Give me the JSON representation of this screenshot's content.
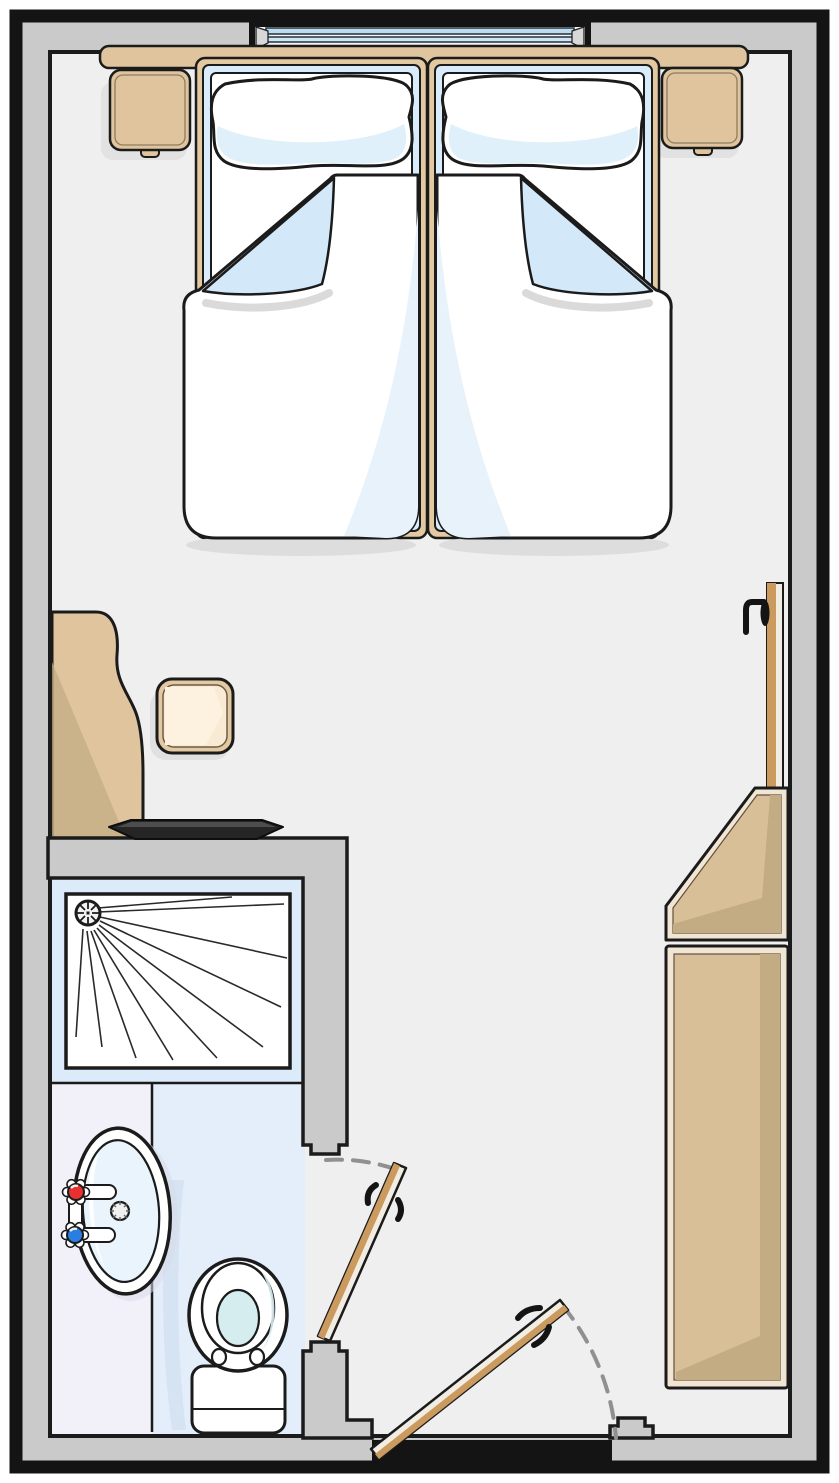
{
  "document": {
    "kind": "floor-plan",
    "view": "top-down",
    "scene": "twin hotel room with en-suite bathroom",
    "visible_text": "none"
  },
  "plan": {
    "rooms": [
      {
        "name": "bedroom",
        "items": [
          "window",
          "headboard",
          "nightstand-left",
          "nightstand-right",
          "twin-bed-left",
          "twin-bed-right",
          "pillow",
          "duvet-with-folded-corner",
          "desk",
          "stool",
          "tv",
          "closet-door-leaf",
          "wardrobe-corner-unit",
          "wardrobe",
          "entrance-door"
        ]
      },
      {
        "name": "bathroom",
        "items": [
          "shower-tray",
          "shower-drain",
          "shower-spray-lines",
          "washbasin",
          "hot-tap",
          "cold-tap",
          "sink-drain",
          "toilet",
          "bathroom-door"
        ]
      }
    ],
    "doors": [
      {
        "name": "bathroom-door",
        "state": "partly-open",
        "swing": "dashed-arc"
      },
      {
        "name": "entrance-door",
        "state": "partly-open",
        "swing": "dashed-arc"
      }
    ],
    "window": {
      "location": "top-wall",
      "panes": 2
    }
  },
  "colors": {
    "wall": "#cacaca",
    "outline": "#141414",
    "lineDark": "#1b1b1b",
    "floor": "#efefef",
    "wood": "#dfc49e",
    "woodFrame": "#e3c9a1",
    "woodMid": "#d9bf97",
    "woodDark": "#c3ac84",
    "cream": "#f1e6d4",
    "sheetBlue": "#d9ecfb",
    "foldBlue": "#d3e8f8",
    "duvetWhite": "#ffffff",
    "sheen": "#e8f2fb",
    "showerZone": "#dcebfa",
    "vanityFloor": "#f2f1fa",
    "bathFloor": "#e3eefa",
    "basin": "#e9f4fc",
    "water": "#d6edf0",
    "hotTap": "#e8302e",
    "coldTap": "#2a7de1",
    "doorWood": "#cb9a5f",
    "doorFace": "#f2ede3",
    "glass1": "#bedcf0",
    "glass2": "#cfe6f6",
    "tv": "#252525",
    "arc": "#909090",
    "stoolTop": "#f8ead3"
  }
}
